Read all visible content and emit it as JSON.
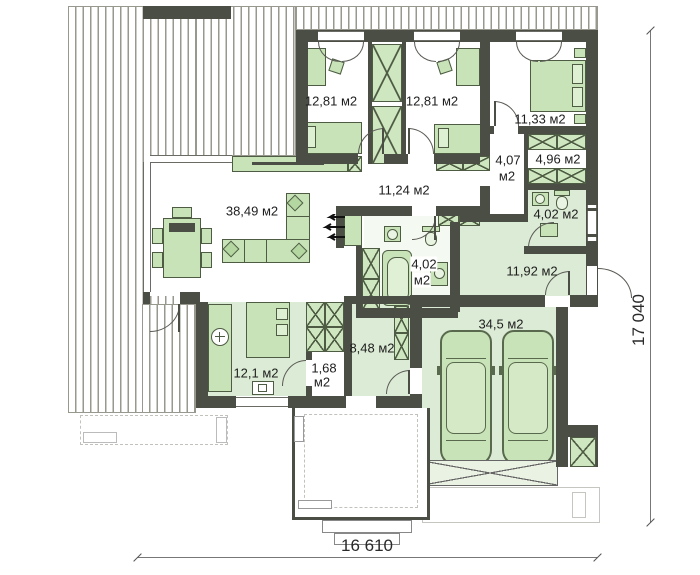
{
  "plan": {
    "type": "single-storey house floor plan",
    "rooms": {
      "bedroom1": {
        "label": "12,81 м2"
      },
      "bedroom2": {
        "label": "12,81 м2"
      },
      "bedroom3": {
        "label": "11,33 м2"
      },
      "wardrobe": {
        "label": "4,96 м2"
      },
      "corridor": {
        "line1": "4,07",
        "line2": "м2"
      },
      "bath_top": {
        "label": "4,02 м2"
      },
      "hall": {
        "label": "11,24 м2"
      },
      "living": {
        "label": "38,49 м2"
      },
      "bath_mid": {
        "line1": "4,02",
        "line2": "м2"
      },
      "utility": {
        "label": "11,92 м2"
      },
      "garage": {
        "label": "34,5 м2"
      },
      "entry": {
        "label": "8,48 м2"
      },
      "kitchen": {
        "label": "12,1 м2"
      },
      "pantry": {
        "line1": "1,68",
        "line2": "м2"
      }
    },
    "dimensions": {
      "bottom": "16 610",
      "right": "17 040"
    },
    "colors": {
      "wall": "#4b4e44",
      "floor_green": "#dcebd5",
      "furniture_green": "#c7e3b7",
      "stripe_gray": "#98988f"
    }
  }
}
